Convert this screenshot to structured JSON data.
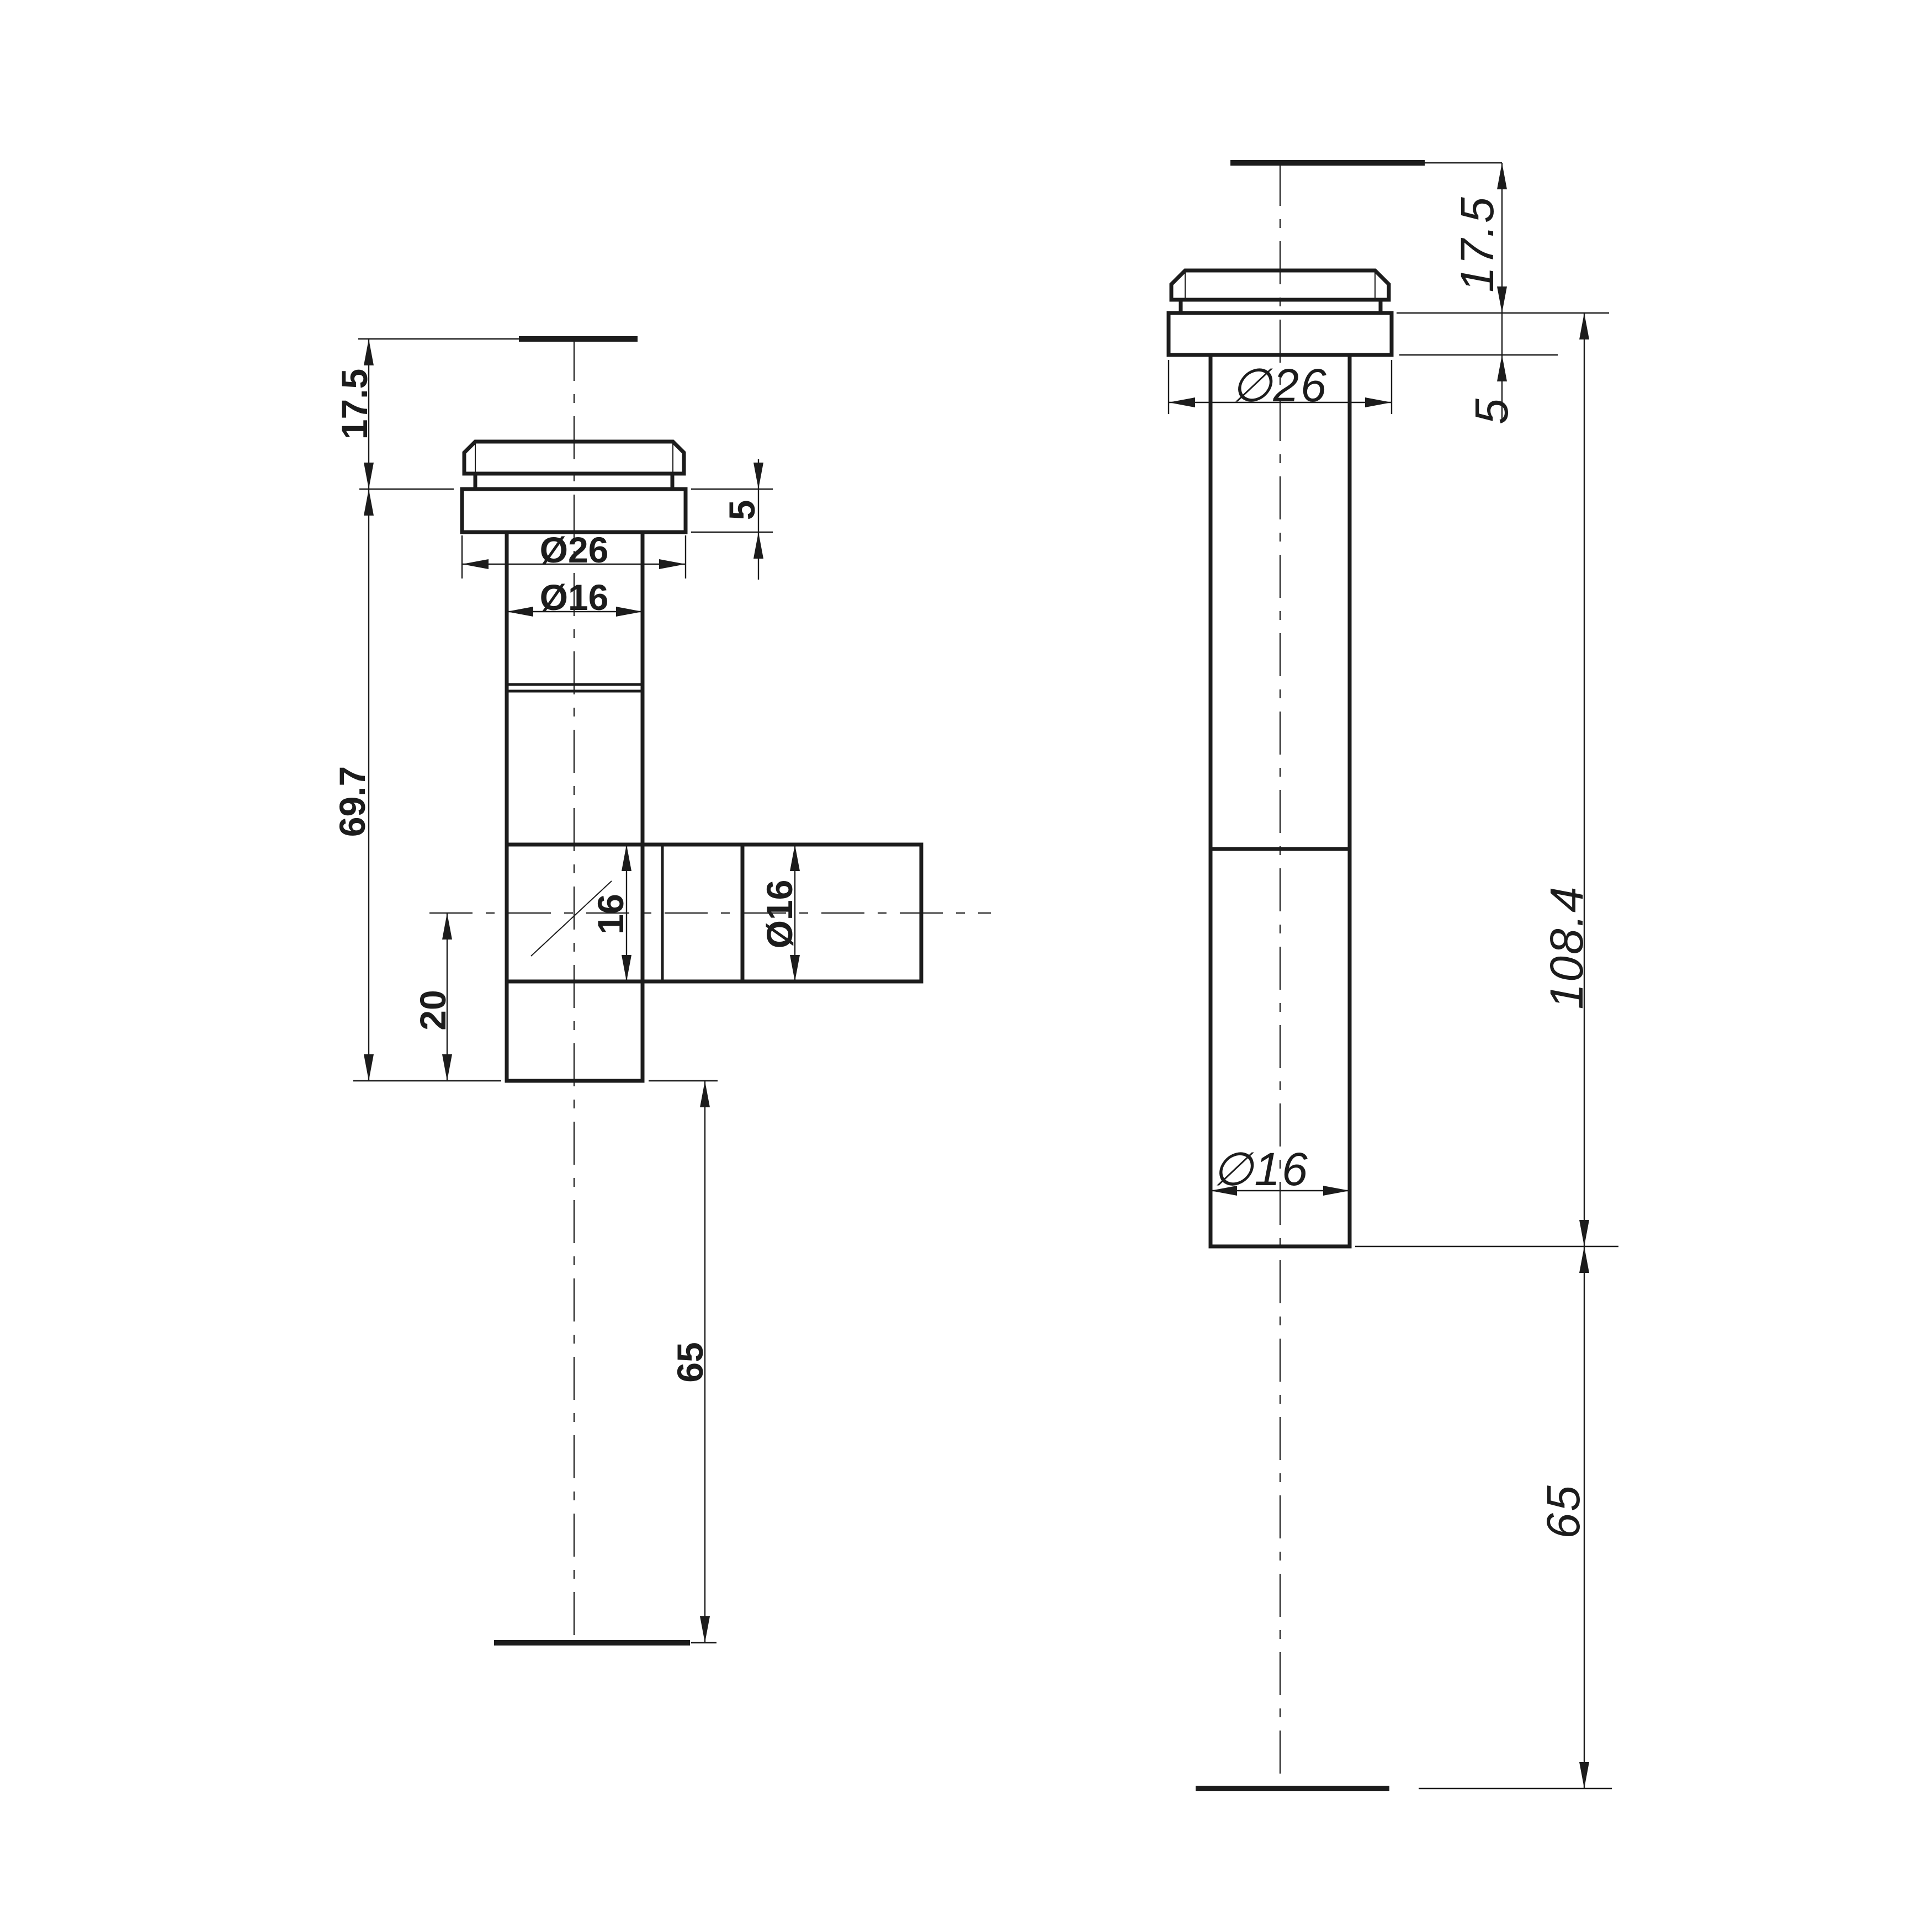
{
  "drawing": {
    "background": "#ffffff",
    "line_color": "#1c1c1c",
    "left_view": {
      "dim_17_5": "17.5",
      "dim_5": "5",
      "dia_26": "Ø26",
      "dia_16_stem": "Ø16",
      "dim_69_7": "69.7",
      "dim_20": "20",
      "dim_16_branch": "16",
      "dia_16_branch": "Ø16",
      "dim_65": "65"
    },
    "right_view": {
      "dim_17_5": "17.5",
      "dim_5": "5",
      "dia_26": "∅26",
      "dia_16": "∅16",
      "dim_108_4": "108.4",
      "dim_65": "65"
    }
  }
}
